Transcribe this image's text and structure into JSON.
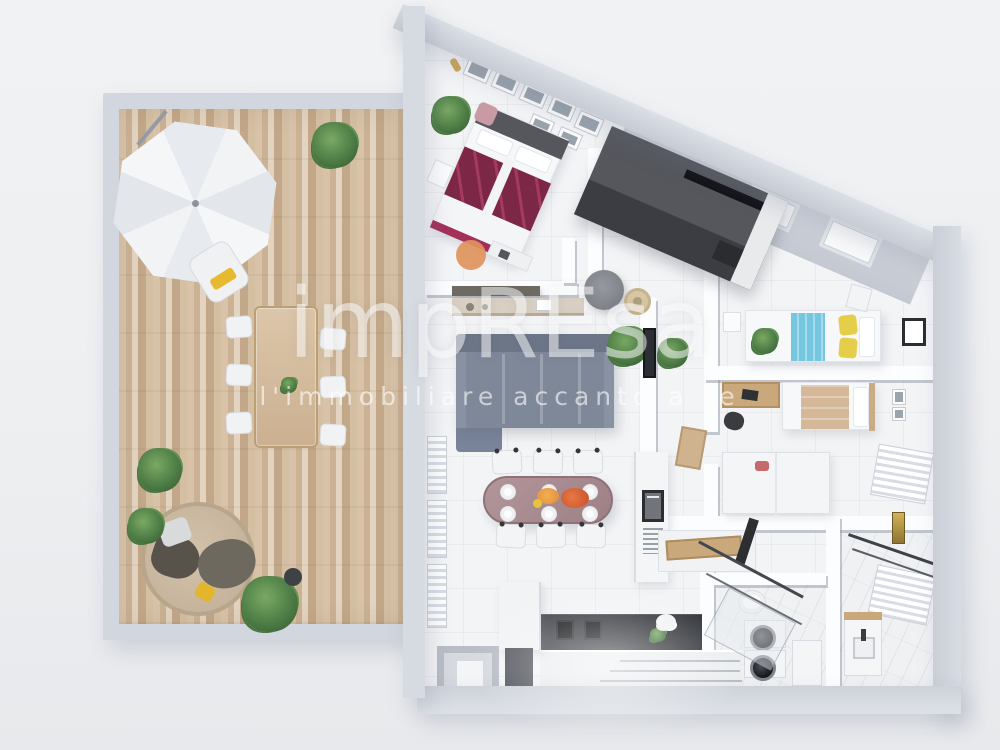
{
  "watermark": {
    "brand": "impREsa",
    "tagline": "l'immobiliare accanto a te"
  },
  "palette": {
    "background": "#eef0f2",
    "outer_wall": "#ccd1d9",
    "inner_wall": "#fcfdfe",
    "floor_tile": "#f3f4f6",
    "terrace_wood": "#cdb394",
    "master_bed_accent": "#7c2746",
    "guest_bed_blue": "#74c7de",
    "guest_pillow_yellow": "#e5cf4a",
    "studio_blanket_tan": "#d4b898",
    "sofa_gray": "#7e8899",
    "dining_table_mauve": "#a98a8e",
    "kitchen_counter_dark": "#3c3f45",
    "wood_furniture": "#c9a87c",
    "plant_green": "#4e7d46",
    "rug_orange": "#e0945c",
    "watermark_white": "#ffffff"
  },
  "rooms": [
    "terrace",
    "master-bedroom",
    "hallway",
    "living-dining-room",
    "kitchen",
    "bedroom-2",
    "studio-bedroom",
    "corridor",
    "laundry-bathroom",
    "bathroom",
    "entry"
  ]
}
